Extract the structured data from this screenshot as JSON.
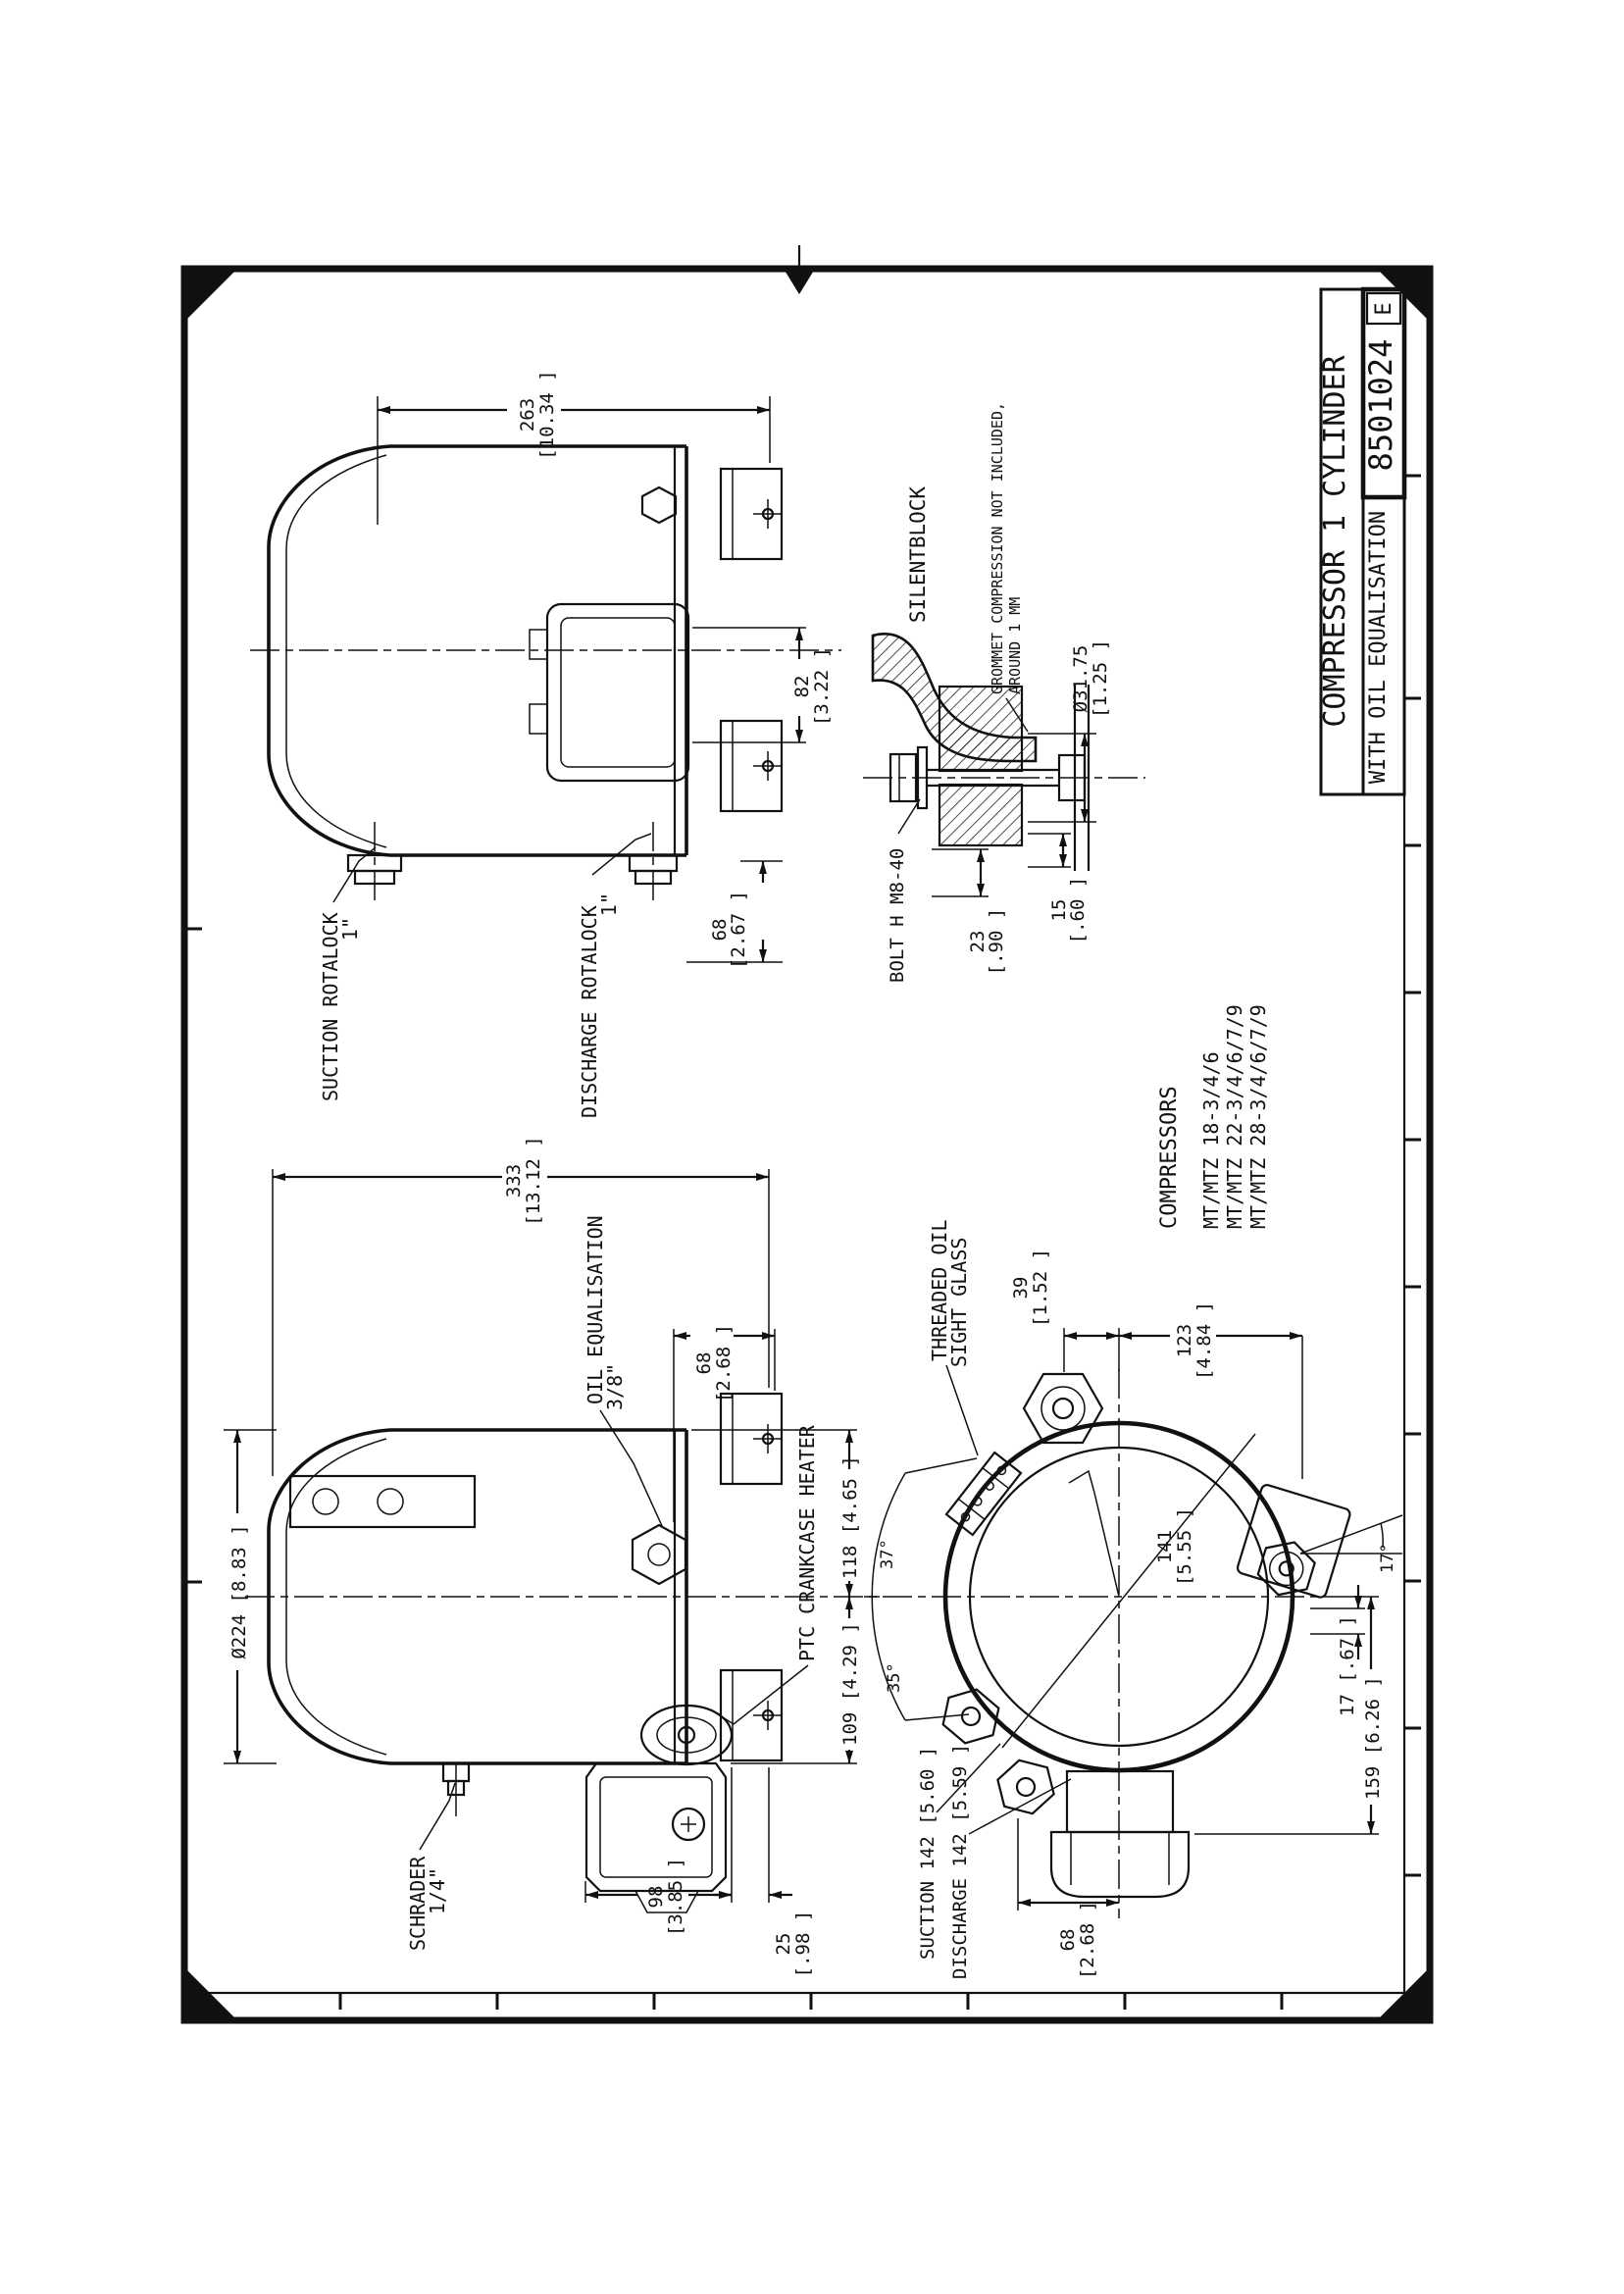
{
  "colors": {
    "ink": "#111111",
    "paper": "#ffffff"
  },
  "title_block": {
    "title_line1": "COMPRESSOR 1 CYLINDER",
    "title_line2": "WITH OIL EQUALISATION",
    "drawing_number": "8501024",
    "revision": "E"
  },
  "compressor_list": {
    "heading": "COMPRESSORS",
    "models": [
      "MT/MTZ 18-3/4/6",
      "MT/MTZ 22-3/4/6/7/9",
      "MT/MTZ 28-3/4/6/7/9"
    ]
  },
  "view_top_side": {
    "dim_height_mm": "263",
    "dim_height_in": "[10.34 ]",
    "label_suction": "SUCTION ROTALOCK",
    "label_suction_size": "1\"",
    "label_discharge": "DISCHARGE ROTALOCK",
    "label_discharge_size": "1\"",
    "dim_foot_mm": "68",
    "dim_foot_in": "[2.67 ]",
    "dim_box_mm": "82",
    "dim_box_in": "[3.22 ]"
  },
  "silentblock": {
    "heading": "SILENTBLOCK",
    "note_line1": "GROMMET COMPRESSION NOT INCLUDED,",
    "note_line2": "AROUND 1 MM",
    "label_bolt": "BOLT H M8-40",
    "dim_grommet_mm": "Ø31.75",
    "dim_grommet_in": "[1.25 ]",
    "dim_23_mm": "23",
    "dim_23_in": "[.90 ]",
    "dim_15_mm": "15",
    "dim_15_in": "[.60 ]"
  },
  "view_front_side": {
    "dim_length_mm": "333",
    "dim_length_in": "[13.12 ]",
    "label_oil_eq": "OIL EQUALISATION",
    "label_oil_eq_size": "3/8\"",
    "dim_diameter": "Ø224 [8.83 ]",
    "label_ptc": "PTC CRANKCASE HEATER",
    "label_schrader": "SCHRADER",
    "label_schrader_size": "1/4\"",
    "dim_68_mm": "68",
    "dim_68_in": "[2.68 ]",
    "dim_98_mm": "98",
    "dim_98_in": "[3.85 ]",
    "dim_25_mm": "25",
    "dim_25_in": "[.98 ]",
    "dim_118": "118 [4.65 ]",
    "dim_109": "109 [4.29 ]"
  },
  "view_top": {
    "label_sight_glass_1": "THREADED OIL",
    "label_sight_glass_2": "SIGHT GLASS",
    "dim_39_mm": "39",
    "dim_39_in": "[1.52 ]",
    "dim_123_mm": "123",
    "dim_123_in": "[4.84 ]",
    "dim_141_mm": "141",
    "dim_141_in": "[5.55 ]",
    "dim_17": "17 [.67 ]",
    "dim_159": "159 [6.26 ]",
    "angle_17": "17°",
    "angle_35": "35°",
    "angle_37": "37°",
    "label_suction_line": "SUCTION  142 [5.60 ]",
    "label_discharge_line": "DISCHARGE  142 [5.59 ]",
    "dim_68_mm": "68",
    "dim_68_in": "[2.68 ]"
  }
}
